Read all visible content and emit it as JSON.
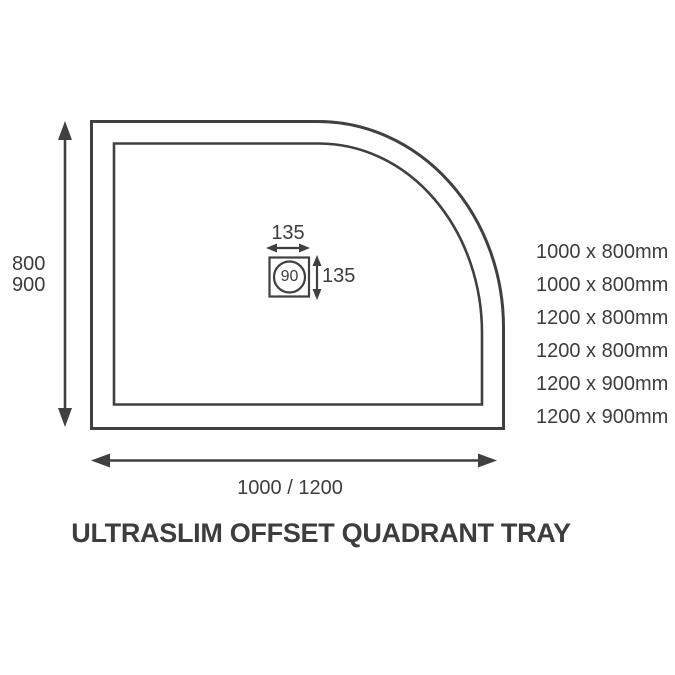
{
  "title": "ULTRASLIM OFFSET QUADRANT TRAY",
  "colors": {
    "line": "#404040",
    "text": "#3d3d3d",
    "background": "#ffffff"
  },
  "dimensions": {
    "height_options": [
      "800",
      "900"
    ],
    "width_label": "1000 / 1200"
  },
  "drain": {
    "width_label": "135",
    "height_label": "135",
    "waste_size": "90"
  },
  "sizes": {
    "items": [
      {
        "label": "1000 x 800mm"
      },
      {
        "label": "1000 x 800mm"
      },
      {
        "label": "1200 x 800mm"
      },
      {
        "label": "1200 x 800mm"
      },
      {
        "label": "1200 x 900mm"
      },
      {
        "label": "1200 x 900mm"
      }
    ]
  }
}
